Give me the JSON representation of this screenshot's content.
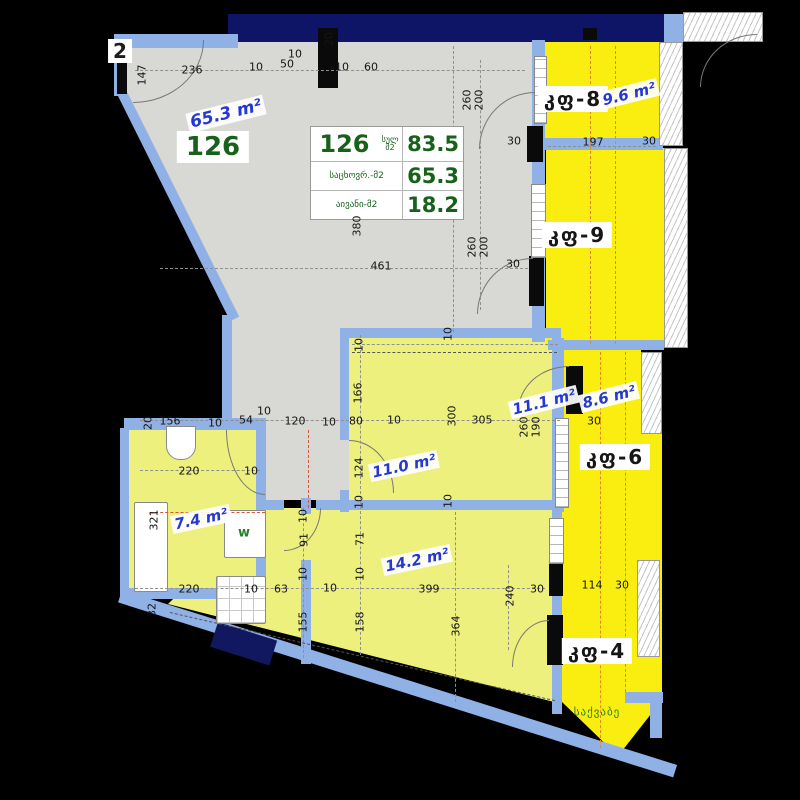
{
  "colors": {
    "wall_blue": "#8fb1e5",
    "exterior_navy": "#0f1566",
    "floor_gray": "#d8d8d5",
    "room_yellow": "#eef07e",
    "balcony_yellow": "#f9ee10",
    "table_green": "#17611b",
    "area_blue": "#2438d4",
    "center_orange": "#e0872a"
  },
  "legend_table": {
    "apartment": "126",
    "total_unit": "სულ მ2",
    "rows": [
      {
        "label": "სულ მ2",
        "value": "83.5"
      },
      {
        "label": "საცხოვრ.-მ2",
        "value": "65.3"
      },
      {
        "label": "აივანი-მ2",
        "value": "18.2"
      }
    ]
  },
  "balcony_labels": [
    {
      "t": "კფ-8",
      "x": 573,
      "y": 99
    },
    {
      "t": "კფ-9",
      "x": 577,
      "y": 235
    },
    {
      "t": "კფ-6",
      "x": 615,
      "y": 457
    },
    {
      "t": "კფ-4",
      "x": 597,
      "y": 651
    }
  ],
  "area_labels": [
    {
      "t": "65.3 m²",
      "x": 226,
      "y": 114,
      "rot": -14,
      "size": 17
    },
    {
      "t": "9.6 m²",
      "x": 629,
      "y": 94,
      "rot": -14,
      "size": 15
    },
    {
      "t": "8.6 m²",
      "x": 609,
      "y": 397,
      "rot": -14,
      "size": 15
    },
    {
      "t": "11.1 m²",
      "x": 544,
      "y": 402,
      "rot": -14,
      "size": 15
    },
    {
      "t": "11.0 m²",
      "x": 404,
      "y": 466,
      "rot": -12,
      "size": 15
    },
    {
      "t": "7.4 m²",
      "x": 201,
      "y": 519,
      "rot": -12,
      "size": 15
    },
    {
      "t": "14.2 m²",
      "x": 417,
      "y": 560,
      "rot": -12,
      "size": 15
    }
  ],
  "annotations": [
    {
      "cls": "unit",
      "t": "126",
      "x": 213,
      "y": 147
    },
    {
      "cls": "neighbor",
      "t": "2",
      "x": 120,
      "y": 51
    },
    {
      "cls": "wmark",
      "t": "w",
      "x": 244,
      "y": 533
    },
    {
      "cls": "boiler",
      "t": "საქვაბე",
      "x": 597,
      "y": 712
    }
  ],
  "dimensions": [
    {
      "t": "147",
      "x": 142,
      "y": 75,
      "v": 1
    },
    {
      "t": "236",
      "x": 192,
      "y": 70
    },
    {
      "t": "10",
      "x": 256,
      "y": 67
    },
    {
      "t": "50",
      "x": 287,
      "y": 64
    },
    {
      "t": "10",
      "x": 295,
      "y": 54
    },
    {
      "t": "20",
      "x": 329,
      "y": 39,
      "v": 1
    },
    {
      "t": "10",
      "x": 342,
      "y": 67
    },
    {
      "t": "60",
      "x": 371,
      "y": 67
    },
    {
      "t": "260",
      "x": 467,
      "y": 100,
      "v": 1
    },
    {
      "t": "200",
      "x": 479,
      "y": 100,
      "v": 1
    },
    {
      "t": "30",
      "x": 514,
      "y": 141
    },
    {
      "t": "197",
      "x": 593,
      "y": 142
    },
    {
      "t": "30",
      "x": 649,
      "y": 141
    },
    {
      "t": "380",
      "x": 357,
      "y": 226,
      "v": 1
    },
    {
      "t": "461",
      "x": 381,
      "y": 266
    },
    {
      "t": "260",
      "x": 472,
      "y": 247,
      "v": 1
    },
    {
      "t": "200",
      "x": 484,
      "y": 247,
      "v": 1
    },
    {
      "t": "30",
      "x": 513,
      "y": 264
    },
    {
      "t": "10",
      "x": 359,
      "y": 345,
      "v": 1
    },
    {
      "t": "10",
      "x": 448,
      "y": 334,
      "v": 1
    },
    {
      "t": "166",
      "x": 358,
      "y": 393,
      "v": 1
    },
    {
      "t": "80",
      "x": 356,
      "y": 421
    },
    {
      "t": "10",
      "x": 394,
      "y": 420
    },
    {
      "t": "300",
      "x": 452,
      "y": 416,
      "v": 1
    },
    {
      "t": "305",
      "x": 482,
      "y": 420
    },
    {
      "t": "260",
      "x": 524,
      "y": 427,
      "v": 1
    },
    {
      "t": "190",
      "x": 536,
      "y": 427,
      "v": 1
    },
    {
      "t": "30",
      "x": 594,
      "y": 421
    },
    {
      "t": "20",
      "x": 148,
      "y": 423,
      "v": 1
    },
    {
      "t": "156",
      "x": 170,
      "y": 421
    },
    {
      "t": "10",
      "x": 215,
      "y": 423
    },
    {
      "t": "54",
      "x": 246,
      "y": 420
    },
    {
      "t": "10",
      "x": 264,
      "y": 411
    },
    {
      "t": "120",
      "x": 295,
      "y": 421
    },
    {
      "t": "10",
      "x": 329,
      "y": 422
    },
    {
      "t": "124",
      "x": 359,
      "y": 468,
      "v": 1
    },
    {
      "t": "10",
      "x": 359,
      "y": 502,
      "v": 1
    },
    {
      "t": "10",
      "x": 448,
      "y": 501,
      "v": 1
    },
    {
      "t": "220",
      "x": 189,
      "y": 471
    },
    {
      "t": "10",
      "x": 251,
      "y": 471
    },
    {
      "t": "321",
      "x": 154,
      "y": 520,
      "v": 1
    },
    {
      "t": "10",
      "x": 303,
      "y": 516,
      "v": 1
    },
    {
      "t": "91",
      "x": 304,
      "y": 540,
      "v": 1
    },
    {
      "t": "71",
      "x": 360,
      "y": 539,
      "v": 1
    },
    {
      "t": "10",
      "x": 303,
      "y": 574,
      "v": 1
    },
    {
      "t": "10",
      "x": 360,
      "y": 574,
      "v": 1
    },
    {
      "t": "220",
      "x": 189,
      "y": 589
    },
    {
      "t": "10",
      "x": 251,
      "y": 589
    },
    {
      "t": "63",
      "x": 281,
      "y": 589
    },
    {
      "t": "10",
      "x": 330,
      "y": 588
    },
    {
      "t": "32",
      "x": 152,
      "y": 610,
      "v": 1
    },
    {
      "t": "155",
      "x": 303,
      "y": 622,
      "v": 1
    },
    {
      "t": "158",
      "x": 360,
      "y": 622,
      "v": 1
    },
    {
      "t": "399",
      "x": 429,
      "y": 589
    },
    {
      "t": "364",
      "x": 456,
      "y": 626,
      "v": 1
    },
    {
      "t": "240",
      "x": 510,
      "y": 596,
      "v": 1
    },
    {
      "t": "30",
      "x": 537,
      "y": 589
    },
    {
      "t": "114",
      "x": 592,
      "y": 585
    },
    {
      "t": "30",
      "x": 622,
      "y": 585
    }
  ]
}
